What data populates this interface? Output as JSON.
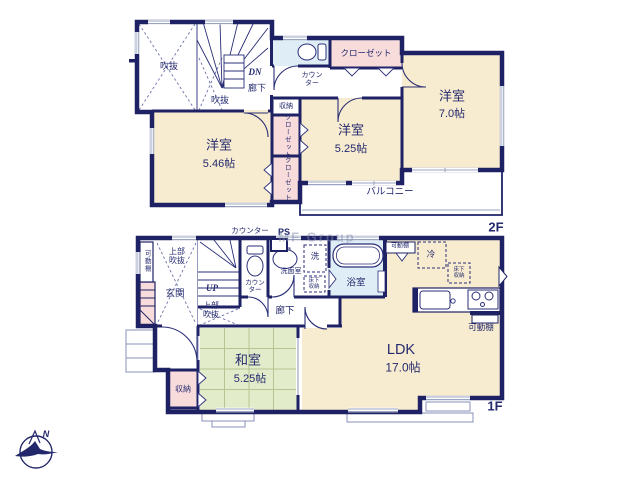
{
  "watermark": "MF Group",
  "compass": {
    "north_label": "N"
  },
  "palette": {
    "wall": "#1e2264",
    "text": "#242a6e",
    "room_beige": "#f8ecd0",
    "closet_pink": "#f8dcdc",
    "bath_blue": "#dfeef6",
    "tatami_green": "#e3ecca",
    "window_gray": "#9aa3c0"
  },
  "floors": [
    {
      "id": "2f",
      "floor_label": "2F",
      "labels": [
        {
          "id": "fukinuke-upper-label",
          "text": "吹抜",
          "x": 169,
          "y": 66,
          "size": 9
        },
        {
          "id": "fukinuke-lower-label",
          "text": "吹抜",
          "x": 220,
          "y": 100,
          "size": 9
        },
        {
          "id": "stairs-down-label",
          "text": "DN",
          "x": 255,
          "y": 72,
          "size": 9,
          "bold": true,
          "italic": true
        },
        {
          "id": "hallway-2f-label",
          "text": "廊下",
          "x": 257,
          "y": 88,
          "size": 9
        },
        {
          "id": "counter-2f-label",
          "text": "カウン\nター",
          "x": 312,
          "y": 80,
          "size": 7
        },
        {
          "id": "closet-top-label",
          "text": "クローゼット",
          "x": 366,
          "y": 54,
          "size": 8.5
        },
        {
          "id": "storage-2f-label",
          "text": "収納",
          "x": 286,
          "y": 107,
          "size": 7
        },
        {
          "id": "closet-v1-label",
          "text": "クローゼット",
          "x": 286,
          "y": 136,
          "size": 6.5,
          "vertical": true
        },
        {
          "id": "closet-v2-label",
          "text": "クローゼット",
          "x": 286,
          "y": 179,
          "size": 6.5,
          "vertical": true
        },
        {
          "id": "room-west-7-name",
          "text": "洋室",
          "x": 452,
          "y": 97,
          "size": 13
        },
        {
          "id": "room-west-7-size",
          "text": "7.0帖",
          "x": 452,
          "y": 114,
          "size": 11
        },
        {
          "id": "room-west-525-name",
          "text": "洋室",
          "x": 351,
          "y": 131,
          "size": 13
        },
        {
          "id": "room-west-525-size",
          "text": "5.25帖",
          "x": 351,
          "y": 149,
          "size": 11
        },
        {
          "id": "room-west-546-name",
          "text": "洋室",
          "x": 219,
          "y": 146,
          "size": 13
        },
        {
          "id": "room-west-546-size",
          "text": "5.46帖",
          "x": 219,
          "y": 164,
          "size": 11
        },
        {
          "id": "balcony-label",
          "text": "バルコニー",
          "x": 390,
          "y": 193,
          "size": 9.5
        },
        {
          "id": "floor-label-2f",
          "text": "2F",
          "x": 496,
          "y": 228,
          "size": 13,
          "bold": true
        }
      ]
    },
    {
      "id": "1f",
      "floor_label": "1F",
      "labels": [
        {
          "id": "counter-above-label",
          "text": "カウンター",
          "x": 250,
          "y": 231,
          "size": 7.5
        },
        {
          "id": "pipe-space-label",
          "text": "PS",
          "x": 284,
          "y": 232,
          "size": 9,
          "bold": true
        },
        {
          "id": "shelf-left-label",
          "text": "可動棚",
          "x": 146,
          "y": 261,
          "size": 6.5,
          "vertical": true
        },
        {
          "id": "upper-void-1-label",
          "text": "上部\n吹抜",
          "x": 177,
          "y": 257,
          "size": 8
        },
        {
          "id": "entrance-label",
          "text": "玄関",
          "x": 175,
          "y": 295,
          "size": 9.5
        },
        {
          "id": "stairs-up-label",
          "text": "UP",
          "x": 212,
          "y": 288,
          "size": 9,
          "bold": true,
          "italic": true
        },
        {
          "id": "upper-void-2-label",
          "text": "上部\n吹抜",
          "x": 211,
          "y": 311,
          "size": 8
        },
        {
          "id": "counter-toilet-label",
          "text": "カウン\nター",
          "x": 255,
          "y": 287,
          "size": 6.5
        },
        {
          "id": "washer-label",
          "text": "洗",
          "x": 315,
          "y": 257,
          "size": 8.5
        },
        {
          "id": "washroom-label",
          "text": "洗面室",
          "x": 291,
          "y": 272,
          "size": 7
        },
        {
          "id": "underfloor-washroom-label",
          "text": "床下\n収納",
          "x": 314,
          "y": 284,
          "size": 5.5
        },
        {
          "id": "bathroom-label",
          "text": "浴室",
          "x": 356,
          "y": 284,
          "size": 9.5
        },
        {
          "id": "hallway-1f-label",
          "text": "廊下",
          "x": 285,
          "y": 312,
          "size": 9.5
        },
        {
          "id": "shelf-top-label",
          "text": "可動棚",
          "x": 400,
          "y": 247,
          "size": 6
        },
        {
          "id": "fridge-label",
          "text": "冷",
          "x": 431,
          "y": 255,
          "size": 8.5
        },
        {
          "id": "underfloor-ldk-label",
          "text": "床下\n収納",
          "x": 459,
          "y": 273,
          "size": 5.5
        },
        {
          "id": "shelf-bottom-label",
          "text": "可動棚",
          "x": 481,
          "y": 328,
          "size": 8.5
        },
        {
          "id": "ldk-name",
          "text": "LDK",
          "x": 401,
          "y": 350,
          "size": 14.5
        },
        {
          "id": "ldk-size",
          "text": "17.0帖",
          "x": 403,
          "y": 368,
          "size": 12
        },
        {
          "id": "washitsu-name",
          "text": "和室",
          "x": 248,
          "y": 361,
          "size": 13
        },
        {
          "id": "washitsu-size",
          "text": "5.25帖",
          "x": 250,
          "y": 379,
          "size": 11
        },
        {
          "id": "storage-1f-label",
          "text": "収納",
          "x": 183,
          "y": 390,
          "size": 8
        },
        {
          "id": "floor-label-1f",
          "text": "1F",
          "x": 495,
          "y": 407,
          "size": 13,
          "bold": true
        }
      ]
    }
  ]
}
